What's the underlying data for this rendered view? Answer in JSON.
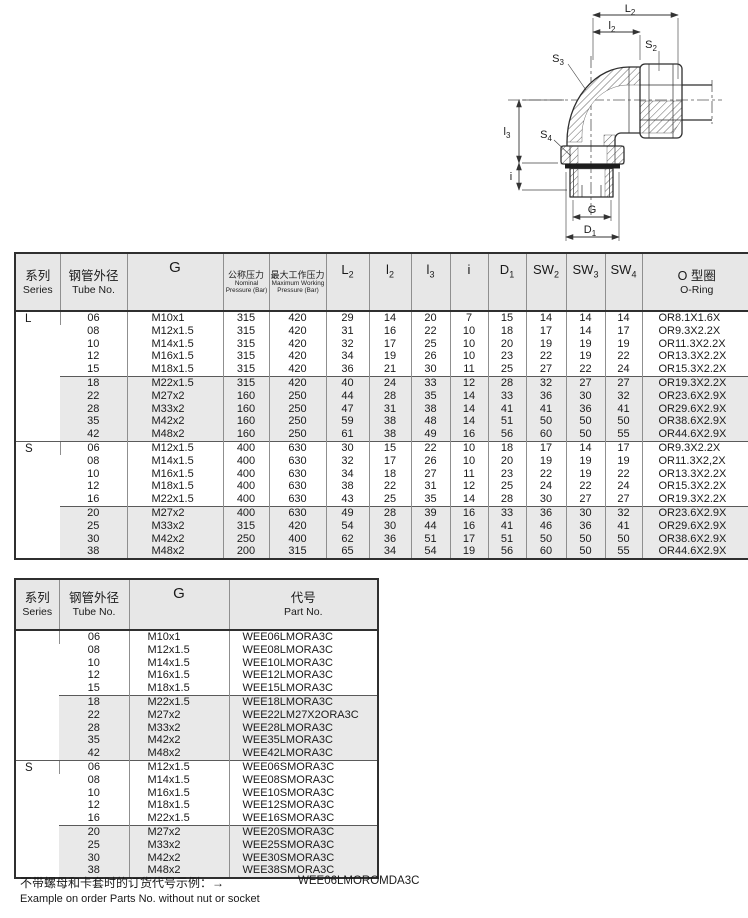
{
  "drawing": {
    "labels": {
      "L2": {
        "base": "L",
        "sub": "2"
      },
      "l2": {
        "base": "l",
        "sub": "2"
      },
      "l3": {
        "base": "l",
        "sub": "3"
      },
      "i": {
        "base": "i",
        "sub": ""
      },
      "G": {
        "base": "G",
        "sub": ""
      },
      "D1": {
        "base": "D",
        "sub": "1"
      },
      "S2": {
        "base": "S",
        "sub": "2"
      },
      "S3": {
        "base": "S",
        "sub": "3"
      },
      "S4": {
        "base": "S",
        "sub": "4"
      }
    }
  },
  "table1": {
    "columns": [
      {
        "zh": "系列",
        "en": "Series"
      },
      {
        "zh": "钢管外径",
        "en": "Tube No."
      },
      {
        "label": "G"
      },
      {
        "zh": "公称压力",
        "en1": "Nominal",
        "en2": "Pressure (Bar)"
      },
      {
        "zh": "最大工作压力",
        "en1": "Maximum Working",
        "en2": "Pressure (Bar)"
      },
      {
        "base": "L",
        "sub": "2"
      },
      {
        "base": "l",
        "sub": "2"
      },
      {
        "base": "l",
        "sub": "3"
      },
      {
        "base": "i",
        "sub": ""
      },
      {
        "base": "D",
        "sub": "1"
      },
      {
        "base": "SW",
        "sub": "2"
      },
      {
        "base": "SW",
        "sub": "3"
      },
      {
        "base": "SW",
        "sub": "4"
      },
      {
        "zh": "O 型圈",
        "en": "O-Ring"
      }
    ],
    "sections": [
      {
        "series": "L",
        "groups": [
          {
            "shaded": false,
            "rows": [
              [
                "06",
                "M10x1",
                "315",
                "420",
                "29",
                "14",
                "20",
                "7",
                "15",
                "14",
                "14",
                "14",
                "OR8.1X1.6X"
              ],
              [
                "08",
                "M12x1.5",
                "315",
                "420",
                "31",
                "16",
                "22",
                "10",
                "18",
                "17",
                "14",
                "17",
                "OR9.3X2.2X"
              ],
              [
                "10",
                "M14x1.5",
                "315",
                "420",
                "32",
                "17",
                "25",
                "10",
                "20",
                "19",
                "19",
                "19",
                "OR11.3X2.2X"
              ],
              [
                "12",
                "M16x1.5",
                "315",
                "420",
                "34",
                "19",
                "26",
                "10",
                "23",
                "22",
                "19",
                "22",
                "OR13.3X2.2X"
              ],
              [
                "15",
                "M18x1.5",
                "315",
                "420",
                "36",
                "21",
                "30",
                "11",
                "25",
                "27",
                "22",
                "24",
                "OR15.3X2.2X"
              ]
            ]
          },
          {
            "shaded": true,
            "rows": [
              [
                "18",
                "M22x1.5",
                "315",
                "420",
                "40",
                "24",
                "33",
                "12",
                "28",
                "32",
                "27",
                "27",
                "OR19.3X2.2X"
              ],
              [
                "22",
                "M27x2",
                "160",
                "250",
                "44",
                "28",
                "35",
                "14",
                "33",
                "36",
                "30",
                "32",
                "OR23.6X2.9X"
              ],
              [
                "28",
                "M33x2",
                "160",
                "250",
                "47",
                "31",
                "38",
                "14",
                "41",
                "41",
                "36",
                "41",
                "OR29.6X2.9X"
              ],
              [
                "35",
                "M42x2",
                "160",
                "250",
                "59",
                "38",
                "48",
                "14",
                "51",
                "50",
                "50",
                "50",
                "OR38.6X2.9X"
              ],
              [
                "42",
                "M48x2",
                "160",
                "250",
                "61",
                "38",
                "49",
                "16",
                "56",
                "60",
                "50",
                "55",
                "OR44.6X2.9X"
              ]
            ]
          }
        ]
      },
      {
        "series": "S",
        "groups": [
          {
            "shaded": false,
            "rows": [
              [
                "06",
                "M12x1.5",
                "400",
                "630",
                "30",
                "15",
                "22",
                "10",
                "18",
                "17",
                "14",
                "17",
                "OR9.3X2.2X"
              ],
              [
                "08",
                "M14x1.5",
                "400",
                "630",
                "32",
                "17",
                "26",
                "10",
                "20",
                "19",
                "19",
                "19",
                "OR11.3X2,2X"
              ],
              [
                "10",
                "M16x1.5",
                "400",
                "630",
                "34",
                "18",
                "27",
                "11",
                "23",
                "22",
                "19",
                "22",
                "OR13.3X2.2X"
              ],
              [
                "12",
                "M18x1.5",
                "400",
                "630",
                "38",
                "22",
                "31",
                "12",
                "25",
                "24",
                "22",
                "24",
                "OR15.3X2.2X"
              ],
              [
                "16",
                "M22x1.5",
                "400",
                "630",
                "43",
                "25",
                "35",
                "14",
                "28",
                "30",
                "27",
                "27",
                "OR19.3X2.2X"
              ]
            ]
          },
          {
            "shaded": true,
            "rows": [
              [
                "20",
                "M27x2",
                "400",
                "630",
                "49",
                "28",
                "39",
                "16",
                "33",
                "36",
                "30",
                "32",
                "OR23.6X2.9X"
              ],
              [
                "25",
                "M33x2",
                "315",
                "420",
                "54",
                "30",
                "44",
                "16",
                "41",
                "46",
                "36",
                "41",
                "OR29.6X2.9X"
              ],
              [
                "30",
                "M42x2",
                "250",
                "400",
                "62",
                "36",
                "51",
                "17",
                "51",
                "50",
                "50",
                "50",
                "OR38.6X2.9X"
              ],
              [
                "38",
                "M48x2",
                "200",
                "315",
                "65",
                "34",
                "54",
                "19",
                "56",
                "60",
                "50",
                "55",
                "OR44.6X2.9X"
              ]
            ]
          }
        ]
      }
    ]
  },
  "table2": {
    "columns": [
      {
        "zh": "系列",
        "en": "Series"
      },
      {
        "zh": "钢管外径",
        "en": "Tube No."
      },
      {
        "label": "G"
      },
      {
        "zh": "代号",
        "en": "Part No."
      }
    ],
    "sections": [
      {
        "series": "",
        "groups": [
          {
            "shaded": false,
            "rows": [
              [
                "06",
                "M10x1",
                "WEE06LMORA3C"
              ],
              [
                "08",
                "M12x1.5",
                "WEE08LMORA3C"
              ],
              [
                "10",
                "M14x1.5",
                "WEE10LMORA3C"
              ],
              [
                "12",
                "M16x1.5",
                "WEE12LMORA3C"
              ],
              [
                "15",
                "M18x1.5",
                "WEE15LMORA3C"
              ]
            ]
          },
          {
            "shaded": true,
            "rows": [
              [
                "18",
                "M22x1.5",
                "WEE18LMORA3C"
              ],
              [
                "22",
                "M27x2",
                "WEE22LM27X2ORA3C"
              ],
              [
                "28",
                "M33x2",
                "WEE28LMORA3C"
              ],
              [
                "35",
                "M42x2",
                "WEE35LMORA3C"
              ],
              [
                "42",
                "M48x2",
                "WEE42LMORA3C"
              ]
            ]
          }
        ]
      },
      {
        "series": "S",
        "groups": [
          {
            "shaded": false,
            "rows": [
              [
                "06",
                "M12x1.5",
                "WEE06SMORA3C"
              ],
              [
                "08",
                "M14x1.5",
                "WEE08SMORA3C"
              ],
              [
                "10",
                "M16x1.5",
                "WEE10SMORA3C"
              ],
              [
                "12",
                "M18x1.5",
                "WEE12SMORA3C"
              ],
              [
                "16",
                "M22x1.5",
                "WEE16SMORA3C"
              ]
            ]
          },
          {
            "shaded": true,
            "rows": [
              [
                "20",
                "M27x2",
                "WEE20SMORA3C"
              ],
              [
                "25",
                "M33x2",
                "WEE25SMORA3C"
              ],
              [
                "30",
                "M42x2",
                "WEE30SMORA3C"
              ],
              [
                "38",
                "M48x2",
                "WEE38SMORA3C"
              ]
            ]
          }
        ]
      }
    ]
  },
  "footer": {
    "line1": "不带螺母和卡套时的订货代号示例：→",
    "example_part": "WEE06LMOROMDA3C",
    "line2": "Example on order Parts No. without nut or socket"
  }
}
